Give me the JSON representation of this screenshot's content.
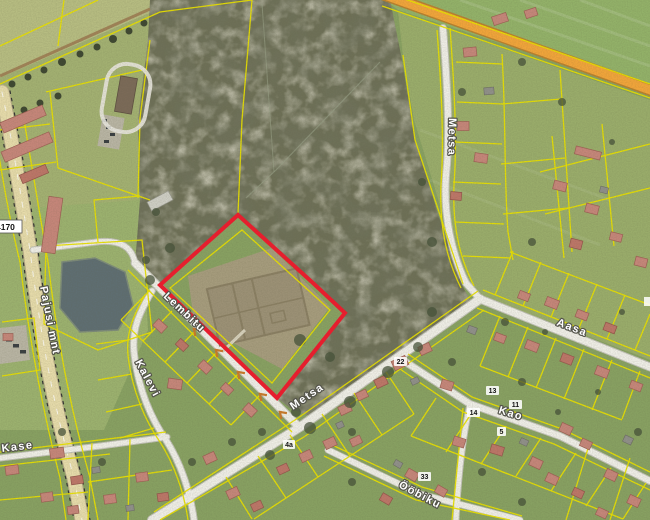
{
  "map": {
    "street_labels": {
      "lembitu": "Lembitu",
      "metsa_upper": "Metsa",
      "metsa_lower": "Metsa",
      "aasa": "Aasa",
      "kao": "Kao",
      "kalevi": "Kalevi",
      "pajusi_mnt": "Pajusi mnt",
      "oobiku": "Ööbiku",
      "kase": "Kase"
    },
    "road_number_badge": "4170",
    "house_numbers": {
      "h22": "22",
      "h13": "13",
      "h11": "11",
      "h14": "14",
      "h5": "5",
      "h4a": "4a",
      "h33": "33"
    },
    "colors": {
      "cadastral_line": "#e8df00",
      "selected_parcel_outline": "#ee1b2d",
      "highlighted_road": "#f2a53a",
      "water": "#5f6e72"
    }
  }
}
